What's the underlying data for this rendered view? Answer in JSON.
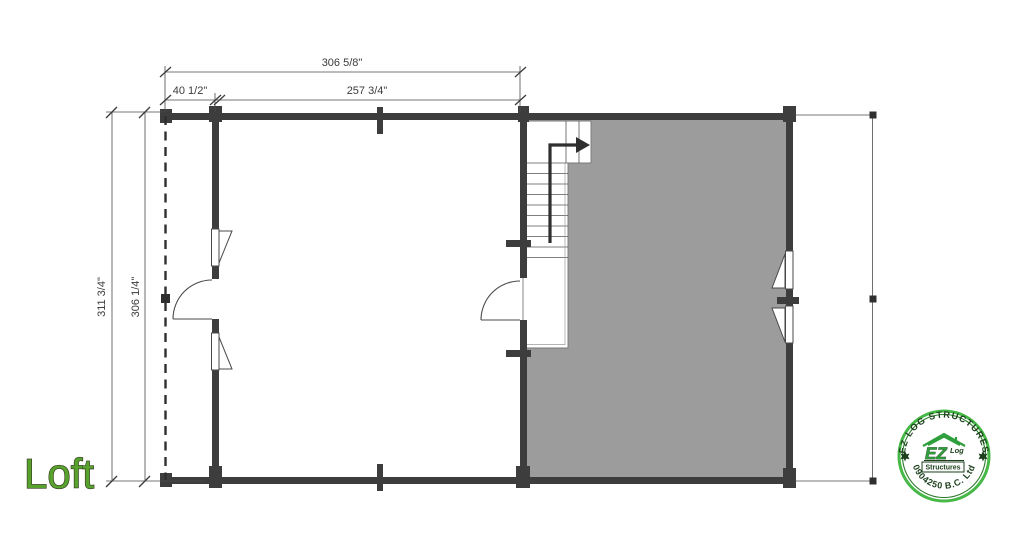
{
  "page": {
    "background": "#ffffff"
  },
  "title": {
    "text": "Loft",
    "color": "#57a12d"
  },
  "plan": {
    "dims": {
      "top_total": "306 5/8\"",
      "top_seg_left": "40 1/2\"",
      "top_seg_right": "257 3/4\"",
      "side_outer": "311 3/4\"",
      "side_inner": "306 1/4\""
    },
    "colors": {
      "wall": "#3d3d3d",
      "loft_fill": "#9c9c9c",
      "dim_line": "#4a4a4a",
      "dim_text": "#3b3b3b"
    },
    "icons": {
      "stair_direction": "up-arrow-icon"
    }
  },
  "stamp": {
    "arc_top": "EZ LOG STRUCTURES",
    "arc_bottom": "0904250 B.C. Ltd",
    "emblem_main": "EZ",
    "emblem_log": "Log",
    "emblem_sub": "Structures",
    "ring_color": "#3cb53c",
    "text_color": "#1c3f1c"
  }
}
